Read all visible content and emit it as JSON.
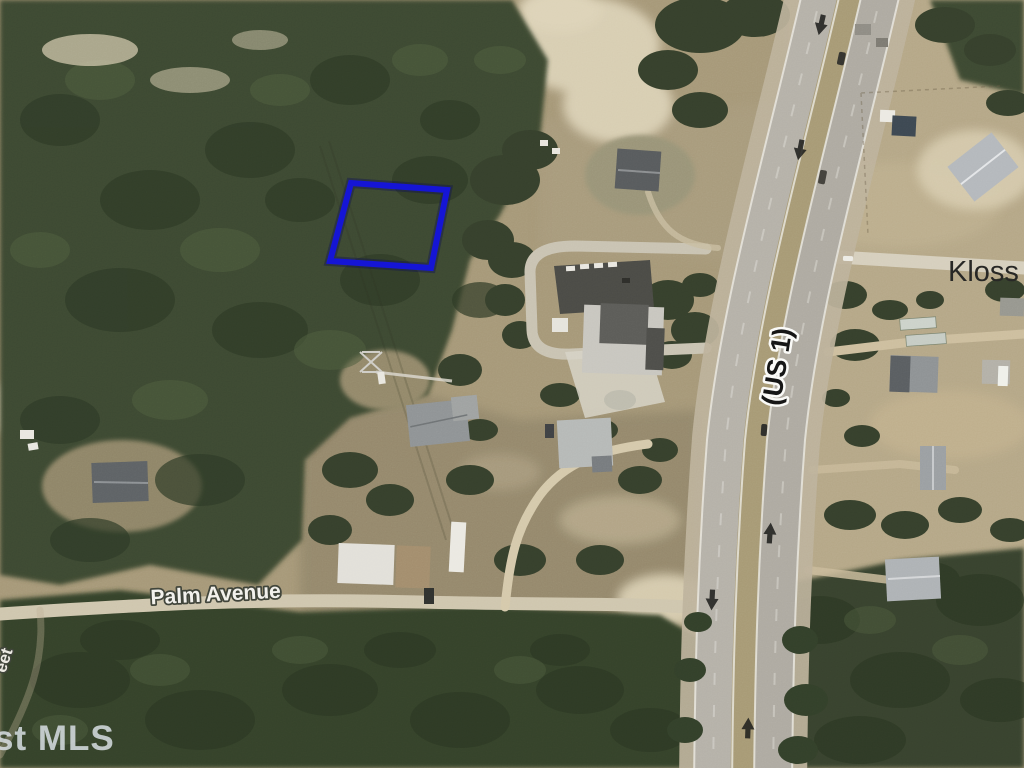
{
  "labels": {
    "street_top_right": "Kloss St",
    "highway": "(US 1)",
    "street_bottom": "Palm Avenue",
    "street_left_partial": "eet",
    "watermark": "st MLS"
  },
  "parcel": {
    "outline_color": "#1414d4"
  },
  "palette": {
    "field": "#a69878",
    "field_right": "#b5a787",
    "field_olive": "#93886c",
    "forest": "#3c4832",
    "sand": "#d8ceb2",
    "pavement": "#b3afa5",
    "median_grass": "#a79a75",
    "dirt_road": "#cfc0a0",
    "lane_arrow": "#1f1f1d",
    "label_dark": "#262624",
    "label_light": "#f2f1ec",
    "watermark_color": "#dde3e9"
  }
}
